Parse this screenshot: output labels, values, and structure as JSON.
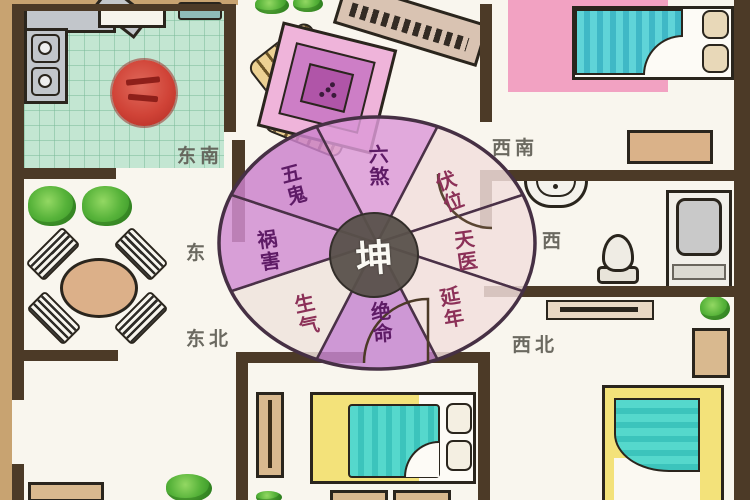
{
  "compass": {
    "center_label": "坤",
    "sectors": [
      {
        "label": "六煞",
        "tone": "purple"
      },
      {
        "label": "伏位",
        "tone": "pale"
      },
      {
        "label": "天医",
        "tone": "pale"
      },
      {
        "label": "延年",
        "tone": "pale"
      },
      {
        "label": "绝命",
        "tone": "purple"
      },
      {
        "label": "生气",
        "tone": "pale"
      },
      {
        "label": "祸害",
        "tone": "purple"
      },
      {
        "label": "五鬼",
        "tone": "purple"
      }
    ]
  },
  "directions": {
    "southeast": "东南",
    "southwest": "西南",
    "east": "东",
    "west": "西",
    "northeast": "东北",
    "northwest": "西北"
  },
  "colors": {
    "wall": "#4c3a27",
    "sector_purple": "#cc82cc",
    "sector_purple_light": "#dc9ad8",
    "sector_pale": "#f2dfdd",
    "center_disc": "#58514b",
    "kitchen_floor": "#c3e6d2",
    "seal_red": "#d04337",
    "rug_pink": "#f2a2c2",
    "bed_teal": "#49d0c4",
    "bed_yellow": "#f3e27a",
    "wood_tan": "#d9b98f",
    "plant_green": "#57b33a"
  }
}
